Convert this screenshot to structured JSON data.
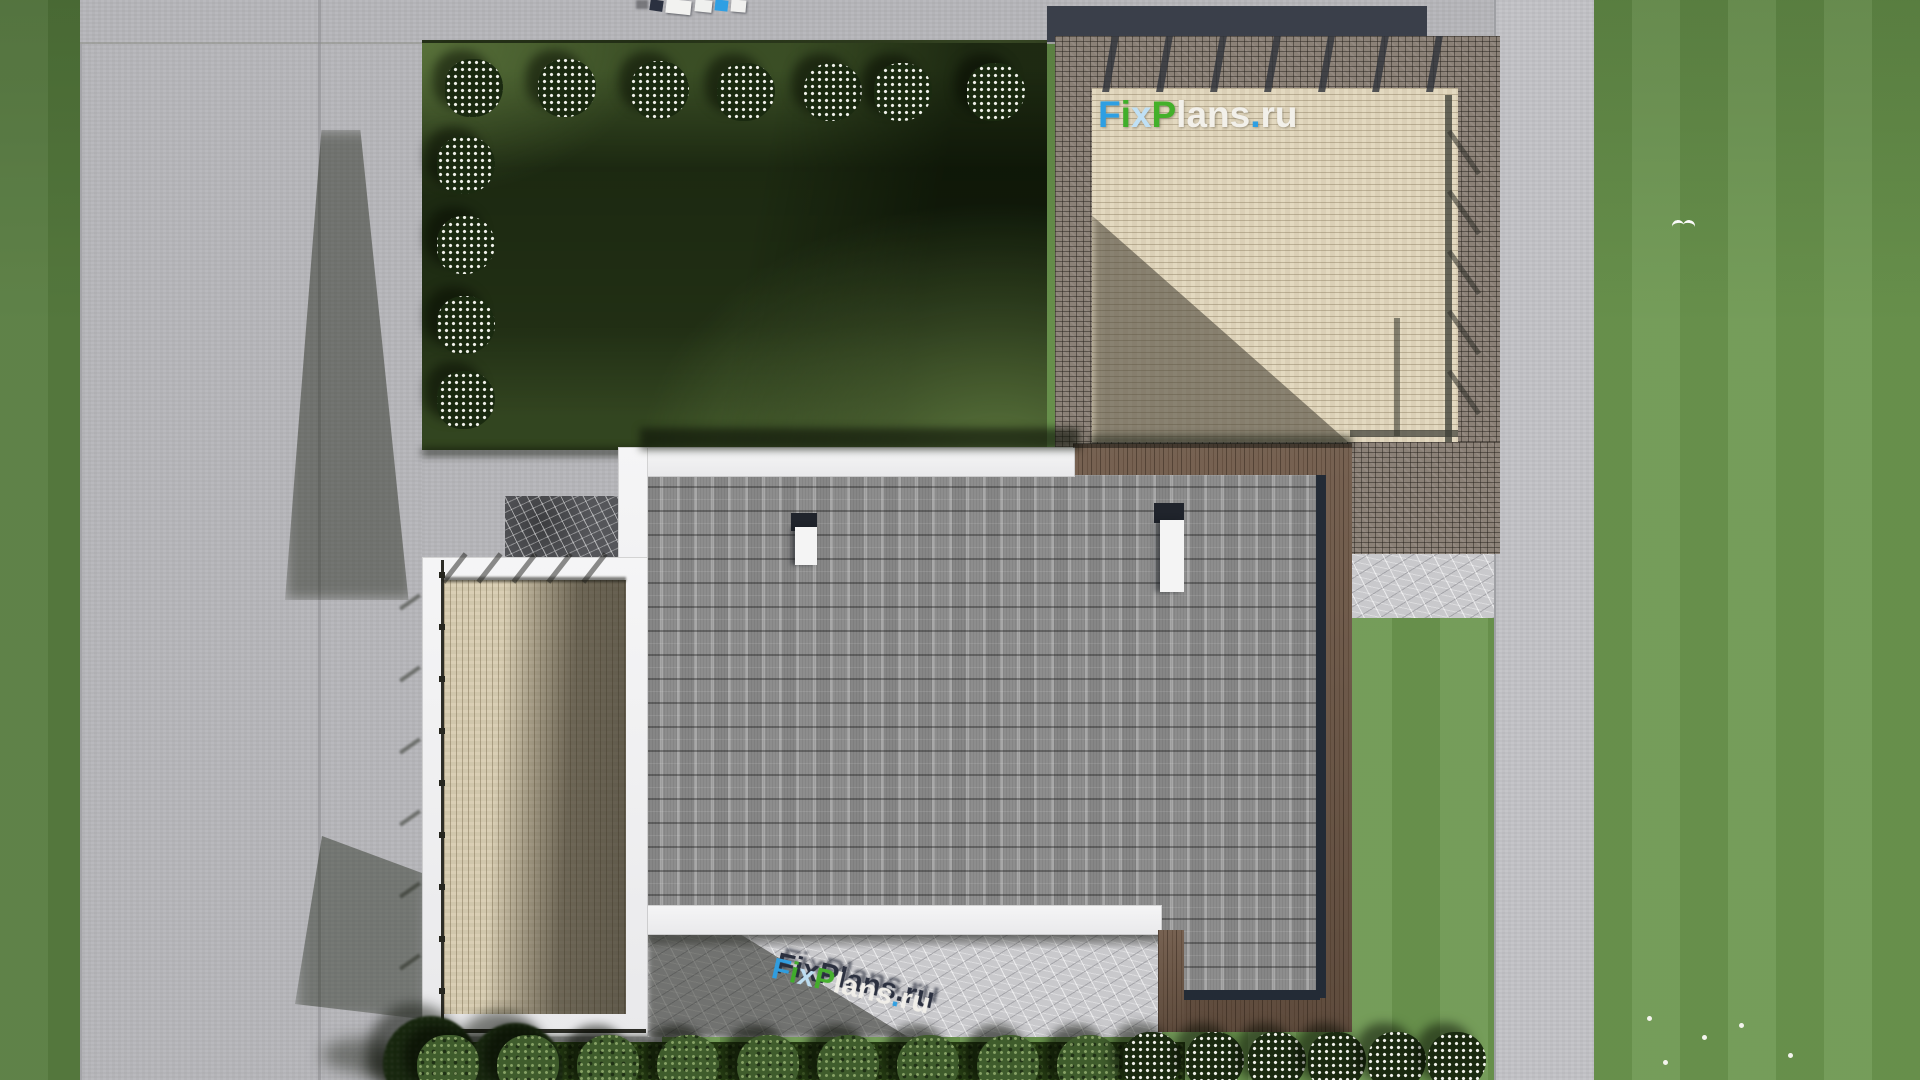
{
  "watermark": {
    "text": "FixPlans.ru",
    "letters": [
      {
        "ch": "F",
        "color": "#2e9fe3"
      },
      {
        "ch": "i",
        "color": "#3fae2a"
      },
      {
        "ch": "x",
        "color": "#bfe0f5"
      },
      {
        "ch": "P",
        "color": "#43b02a"
      },
      {
        "ch": "l",
        "color": "#f2f0ea"
      },
      {
        "ch": "a",
        "color": "#f2f0ea"
      },
      {
        "ch": "n",
        "color": "#f2f0ea"
      },
      {
        "ch": "s",
        "color": "#f2f0ea"
      },
      {
        "ch": ".",
        "color": "#2e9fe3"
      },
      {
        "ch": "r",
        "color": "#f2f0ea"
      },
      {
        "ch": "u",
        "color": "#f2f0ea"
      }
    ],
    "extrusion_color": "#262c3b"
  },
  "palette": {
    "grass_light": "#6d9750",
    "grass_shadow": "#1f3312",
    "road": "#b6b6ba",
    "roof_shingle": "#a8a8a8",
    "deck_wood": "#d9ceb3",
    "walnut_band": "#6e5847",
    "brick_border": "#8b8177",
    "parapet_white": "#eeeeef",
    "marble_paving": "#c9c9cc",
    "dark_stone": "#55565a",
    "brand_blue": "#2e9fe3",
    "brand_green": "#43b02a"
  }
}
